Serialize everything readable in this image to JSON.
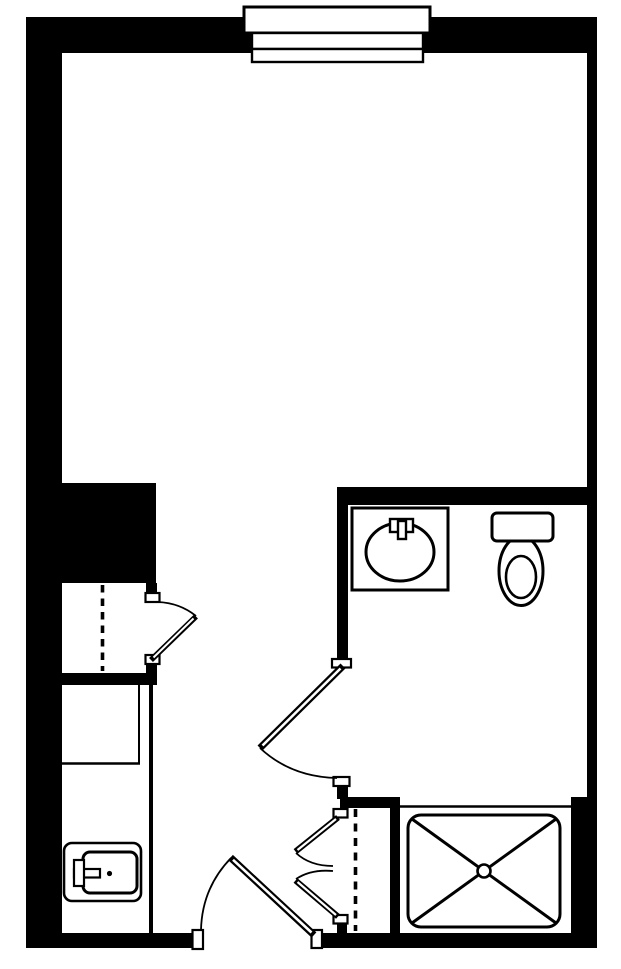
{
  "canvas": {
    "width": 621,
    "height": 969,
    "background": "#ffffff",
    "ink": "#000000"
  },
  "plan": {
    "kind": "studio-apartment-floor-plan",
    "visible_text": [],
    "fixtures": [
      "window",
      "wardrobe-closet",
      "kitchenette-counter",
      "kitchen-sink",
      "entry-door",
      "bathroom-door",
      "closet-door",
      "linen-closet-double-doors",
      "bathroom-vanity-sink",
      "toilet",
      "shower"
    ]
  },
  "shapes": [
    {
      "name": "wall-left",
      "kind": "rect",
      "x": 26,
      "y": 17,
      "w": 36,
      "h": 931,
      "fill": "#000000"
    },
    {
      "name": "wall-top",
      "kind": "rect",
      "x": 26,
      "y": 17,
      "w": 571,
      "h": 36,
      "fill": "#000000"
    },
    {
      "name": "wall-right-upper",
      "kind": "rect",
      "x": 587,
      "y": 17,
      "w": 10,
      "h": 781,
      "fill": "#000000"
    },
    {
      "name": "wall-right-lower",
      "kind": "rect",
      "x": 571,
      "y": 797,
      "w": 26,
      "h": 151,
      "fill": "#000000"
    },
    {
      "name": "wall-bottom-left",
      "kind": "rect",
      "x": 26,
      "y": 933,
      "w": 167,
      "h": 15,
      "fill": "#000000"
    },
    {
      "name": "wall-bottom-right",
      "kind": "rect",
      "x": 322,
      "y": 933,
      "w": 275,
      "h": 15,
      "fill": "#000000"
    },
    {
      "name": "wall-block-closet",
      "kind": "rect",
      "x": 26,
      "y": 483,
      "w": 130,
      "h": 100,
      "fill": "#000000"
    },
    {
      "name": "wall-closet-stub-top",
      "kind": "rect",
      "x": 146,
      "y": 583,
      "w": 11,
      "h": 12,
      "fill": "#000000"
    },
    {
      "name": "wall-closet-stub-bottom",
      "kind": "rect",
      "x": 146,
      "y": 662,
      "w": 11,
      "h": 13,
      "fill": "#000000"
    },
    {
      "name": "wall-closet-counter-divider",
      "kind": "rect",
      "x": 62,
      "y": 673,
      "w": 95,
      "h": 12,
      "fill": "#000000"
    },
    {
      "name": "wall-bathroom-top",
      "kind": "rect",
      "x": 337,
      "y": 487,
      "w": 260,
      "h": 18,
      "fill": "#000000"
    },
    {
      "name": "wall-bathroom-left",
      "kind": "rect",
      "x": 337,
      "y": 505,
      "w": 11,
      "h": 154,
      "fill": "#000000"
    },
    {
      "name": "wall-bathroom-left-stub",
      "kind": "rect",
      "x": 337,
      "y": 785,
      "w": 11,
      "h": 14,
      "fill": "#000000"
    },
    {
      "name": "wall-linen-closet-top",
      "kind": "rect",
      "x": 340,
      "y": 797,
      "w": 60,
      "h": 11,
      "fill": "#000000"
    },
    {
      "name": "wall-linen-closet-right",
      "kind": "rect",
      "x": 390,
      "y": 805,
      "w": 10,
      "h": 130,
      "fill": "#000000"
    },
    {
      "name": "wall-linen-closet-stub",
      "kind": "rect",
      "x": 337,
      "y": 921,
      "w": 10,
      "h": 14,
      "fill": "#000000"
    },
    {
      "name": "window-frame",
      "kind": "rect",
      "x": 244,
      "y": 7,
      "w": 186,
      "h": 26,
      "fill": "#ffffff",
      "stroke": "#000000",
      "sw": 3
    },
    {
      "name": "window-pane-upper",
      "kind": "rect",
      "x": 252,
      "y": 33,
      "w": 171,
      "h": 16,
      "fill": "#ffffff",
      "stroke": "#000000",
      "sw": 2.4
    },
    {
      "name": "window-pane-lower",
      "kind": "rect",
      "x": 252,
      "y": 49,
      "w": 171,
      "h": 13,
      "fill": "#ffffff",
      "stroke": "#000000",
      "sw": 2.4
    },
    {
      "name": "counter-inner-line",
      "kind": "line",
      "x1": 139,
      "y1": 685,
      "x2": 139,
      "y2": 763,
      "stroke": "#000000",
      "sw": 2
    },
    {
      "name": "counter-divider-line",
      "kind": "line",
      "x1": 62,
      "y1": 763.5,
      "x2": 140,
      "y2": 763.5,
      "stroke": "#000000",
      "sw": 2.4
    },
    {
      "name": "counter-edge-line",
      "kind": "line",
      "x1": 151,
      "y1": 685,
      "x2": 151,
      "y2": 933,
      "stroke": "#000000",
      "sw": 4
    },
    {
      "name": "kitchen-sink-counter",
      "kind": "rect",
      "x": 64,
      "y": 843,
      "w": 77,
      "h": 58,
      "rx": 8,
      "fill": "#ffffff",
      "stroke": "#000000",
      "sw": 2.6
    },
    {
      "name": "kitchen-sink-basin",
      "kind": "rect",
      "x": 83,
      "y": 852,
      "w": 54,
      "h": 41,
      "rx": 7,
      "fill": "#ffffff",
      "stroke": "#000000",
      "sw": 3
    },
    {
      "name": "kitchen-sink-spout",
      "kind": "rect",
      "x": 74,
      "y": 869,
      "w": 26,
      "h": 8.5,
      "fill": "#ffffff",
      "stroke": "#000000",
      "sw": 2.2
    },
    {
      "name": "kitchen-sink-handle",
      "kind": "rect",
      "x": 74,
      "y": 860,
      "w": 10,
      "h": 26,
      "fill": "#ffffff",
      "stroke": "#000000",
      "sw": 2.2
    },
    {
      "name": "kitchen-sink-drain",
      "kind": "circle",
      "cx": 109.5,
      "cy": 873.5,
      "r": 2.6,
      "fill": "#000000"
    },
    {
      "name": "vanity-counter",
      "kind": "rect",
      "x": 352,
      "y": 508,
      "w": 96,
      "h": 82,
      "fill": "#ffffff",
      "stroke": "#000000",
      "sw": 3
    },
    {
      "name": "vanity-basin",
      "kind": "ellipse",
      "cx": 400,
      "cy": 552,
      "rx": 34,
      "ry": 29,
      "fill": "#ffffff",
      "stroke": "#000000",
      "sw": 3
    },
    {
      "name": "vanity-faucet-base",
      "kind": "rect",
      "x": 390,
      "y": 519,
      "w": 23,
      "h": 13,
      "fill": "#ffffff",
      "stroke": "#000000",
      "sw": 2.4
    },
    {
      "name": "vanity-faucet-stem",
      "kind": "rect",
      "x": 398,
      "y": 521,
      "w": 8,
      "h": 18,
      "fill": "#ffffff",
      "stroke": "#000000",
      "sw": 2.4
    },
    {
      "name": "toilet-bowl",
      "kind": "ellipse",
      "cx": 521,
      "cy": 571,
      "rx": 22,
      "ry": 34.5,
      "fill": "#ffffff",
      "stroke": "#000000",
      "sw": 3
    },
    {
      "name": "toilet-tank",
      "kind": "rect",
      "x": 492,
      "y": 513,
      "w": 61,
      "h": 28,
      "rx": 5,
      "fill": "#ffffff",
      "stroke": "#000000",
      "sw": 3
    },
    {
      "name": "toilet-seat",
      "kind": "ellipse",
      "cx": 521,
      "cy": 577,
      "rx": 15,
      "ry": 21,
      "fill": "#ffffff",
      "stroke": "#000000",
      "sw": 2.6
    },
    {
      "name": "shower-front-line",
      "kind": "line",
      "x1": 400,
      "y1": 806.5,
      "x2": 572,
      "y2": 806.5,
      "stroke": "#000000",
      "sw": 2.4
    },
    {
      "name": "shower-pan",
      "kind": "rect",
      "x": 408,
      "y": 815,
      "w": 152,
      "h": 112,
      "rx": 13,
      "fill": "#ffffff",
      "stroke": "#000000",
      "sw": 3
    },
    {
      "name": "shower-diagonal-1",
      "kind": "line",
      "x1": 412,
      "y1": 819,
      "x2": 556,
      "y2": 923,
      "stroke": "#000000",
      "sw": 3
    },
    {
      "name": "shower-diagonal-2",
      "kind": "line",
      "x1": 556,
      "y1": 819,
      "x2": 412,
      "y2": 923,
      "stroke": "#000000",
      "sw": 3
    },
    {
      "name": "shower-drain",
      "kind": "circle",
      "cx": 484,
      "cy": 871,
      "r": 6.5,
      "fill": "#ffffff",
      "stroke": "#000000",
      "sw": 2.6
    },
    {
      "name": "closet-rod-dashed",
      "kind": "line",
      "x1": 102.5,
      "y1": 585,
      "x2": 102.5,
      "y2": 671,
      "stroke": "#000000",
      "sw": 3.6,
      "dash": "7.5 6"
    },
    {
      "name": "linen-rod-dashed",
      "kind": "line",
      "x1": 355.5,
      "y1": 809,
      "x2": 355.5,
      "y2": 931,
      "stroke": "#000000",
      "sw": 3.6,
      "dash": "8 6.5"
    },
    {
      "name": "closet-door-jamb-top",
      "kind": "rect",
      "x": 145.5,
      "y": 593,
      "w": 14,
      "h": 9,
      "fill": "#ffffff",
      "stroke": "#000000",
      "sw": 2.2
    },
    {
      "name": "closet-door-jamb-bottom",
      "kind": "rect",
      "x": 145.5,
      "y": 655,
      "w": 14,
      "h": 9,
      "fill": "#ffffff",
      "stroke": "#000000",
      "sw": 2.2
    },
    {
      "name": "bathroom-door-jamb-top",
      "kind": "rect",
      "x": 332,
      "y": 659,
      "w": 19,
      "h": 8.5,
      "fill": "#ffffff",
      "stroke": "#000000",
      "sw": 2.2
    },
    {
      "name": "bathroom-door-jamb-bottom",
      "kind": "rect",
      "x": 333.5,
      "y": 777,
      "w": 16,
      "h": 9,
      "fill": "#ffffff",
      "stroke": "#000000",
      "sw": 2.2
    },
    {
      "name": "linen-door-jamb-top",
      "kind": "rect",
      "x": 333.5,
      "y": 809,
      "w": 14,
      "h": 8.5,
      "fill": "#ffffff",
      "stroke": "#000000",
      "sw": 2.2
    },
    {
      "name": "linen-door-jamb-bottom",
      "kind": "rect",
      "x": 333.5,
      "y": 915,
      "w": 14,
      "h": 8.5,
      "fill": "#ffffff",
      "stroke": "#000000",
      "sw": 2.2
    },
    {
      "name": "entry-door-jamb-left",
      "kind": "rect",
      "x": 192.5,
      "y": 930,
      "w": 10.5,
      "h": 19,
      "fill": "#ffffff",
      "stroke": "#000000",
      "sw": 2.2
    },
    {
      "name": "entry-door-jamb-right",
      "kind": "rect",
      "x": 311.5,
      "y": 930,
      "w": 10.5,
      "h": 18,
      "fill": "#ffffff",
      "stroke": "#000000",
      "sw": 2.2
    },
    {
      "name": "closet-door-swing-arc",
      "kind": "path",
      "d": "M158,602 Q180,603 196,616",
      "fill": "none",
      "stroke": "#000000",
      "sw": 1.8
    },
    {
      "name": "bathroom-door-swing-arc",
      "kind": "path",
      "d": "M260,748 Q291,777 337,778",
      "fill": "none",
      "stroke": "#000000",
      "sw": 1.8
    },
    {
      "name": "entry-door-swing-arc",
      "kind": "path",
      "d": "M201,930 Q202,888 231,858",
      "fill": "none",
      "stroke": "#000000",
      "sw": 1.8
    },
    {
      "name": "linen-door-swing-arc-top",
      "kind": "path",
      "d": "M296,853 Q310,866 333,866",
      "fill": "none",
      "stroke": "#000000",
      "sw": 1.8
    },
    {
      "name": "linen-door-swing-arc-bottom",
      "kind": "path",
      "d": "M296,879 Q311,869 333,871",
      "fill": "none",
      "stroke": "#000000",
      "sw": 1.8
    },
    {
      "name": "closet-door-leaf",
      "kind": "line",
      "x1": 151,
      "y1": 660,
      "x2": 196,
      "y2": 616.5,
      "stroke": "#000000",
      "sw": 5.6
    },
    {
      "name": "closet-door-leaf-core",
      "kind": "line",
      "x1": 153.5,
      "y1": 657.5,
      "x2": 193.5,
      "y2": 618.5,
      "stroke": "#ffffff",
      "sw": 2
    },
    {
      "name": "bathroom-door-leaf",
      "kind": "line",
      "x1": 343,
      "y1": 666,
      "x2": 260,
      "y2": 748,
      "stroke": "#000000",
      "sw": 7
    },
    {
      "name": "bathroom-door-leaf-core",
      "kind": "line",
      "x1": 340.5,
      "y1": 668.5,
      "x2": 262.5,
      "y2": 745.5,
      "stroke": "#ffffff",
      "sw": 2.6
    },
    {
      "name": "entry-door-leaf",
      "kind": "line",
      "x1": 314,
      "y1": 935,
      "x2": 230.5,
      "y2": 857.5,
      "stroke": "#000000",
      "sw": 7
    },
    {
      "name": "entry-door-leaf-core",
      "kind": "line",
      "x1": 311.5,
      "y1": 932.5,
      "x2": 233,
      "y2": 859.8,
      "stroke": "#ffffff",
      "sw": 2.6
    },
    {
      "name": "linen-door-leaf-top",
      "kind": "line",
      "x1": 338,
      "y1": 817.5,
      "x2": 295.5,
      "y2": 851.5,
      "stroke": "#000000",
      "sw": 6
    },
    {
      "name": "linen-door-leaf-top-core",
      "kind": "line",
      "x1": 336,
      "y1": 819,
      "x2": 297.5,
      "y2": 850,
      "stroke": "#ffffff",
      "sw": 2.2
    },
    {
      "name": "linen-door-leaf-bottom",
      "kind": "line",
      "x1": 338,
      "y1": 916.5,
      "x2": 295.5,
      "y2": 880.5,
      "stroke": "#000000",
      "sw": 6
    },
    {
      "name": "linen-door-leaf-bottom-core",
      "kind": "line",
      "x1": 336,
      "y1": 915,
      "x2": 297.5,
      "y2": 882,
      "stroke": "#ffffff",
      "sw": 2.2
    }
  ]
}
